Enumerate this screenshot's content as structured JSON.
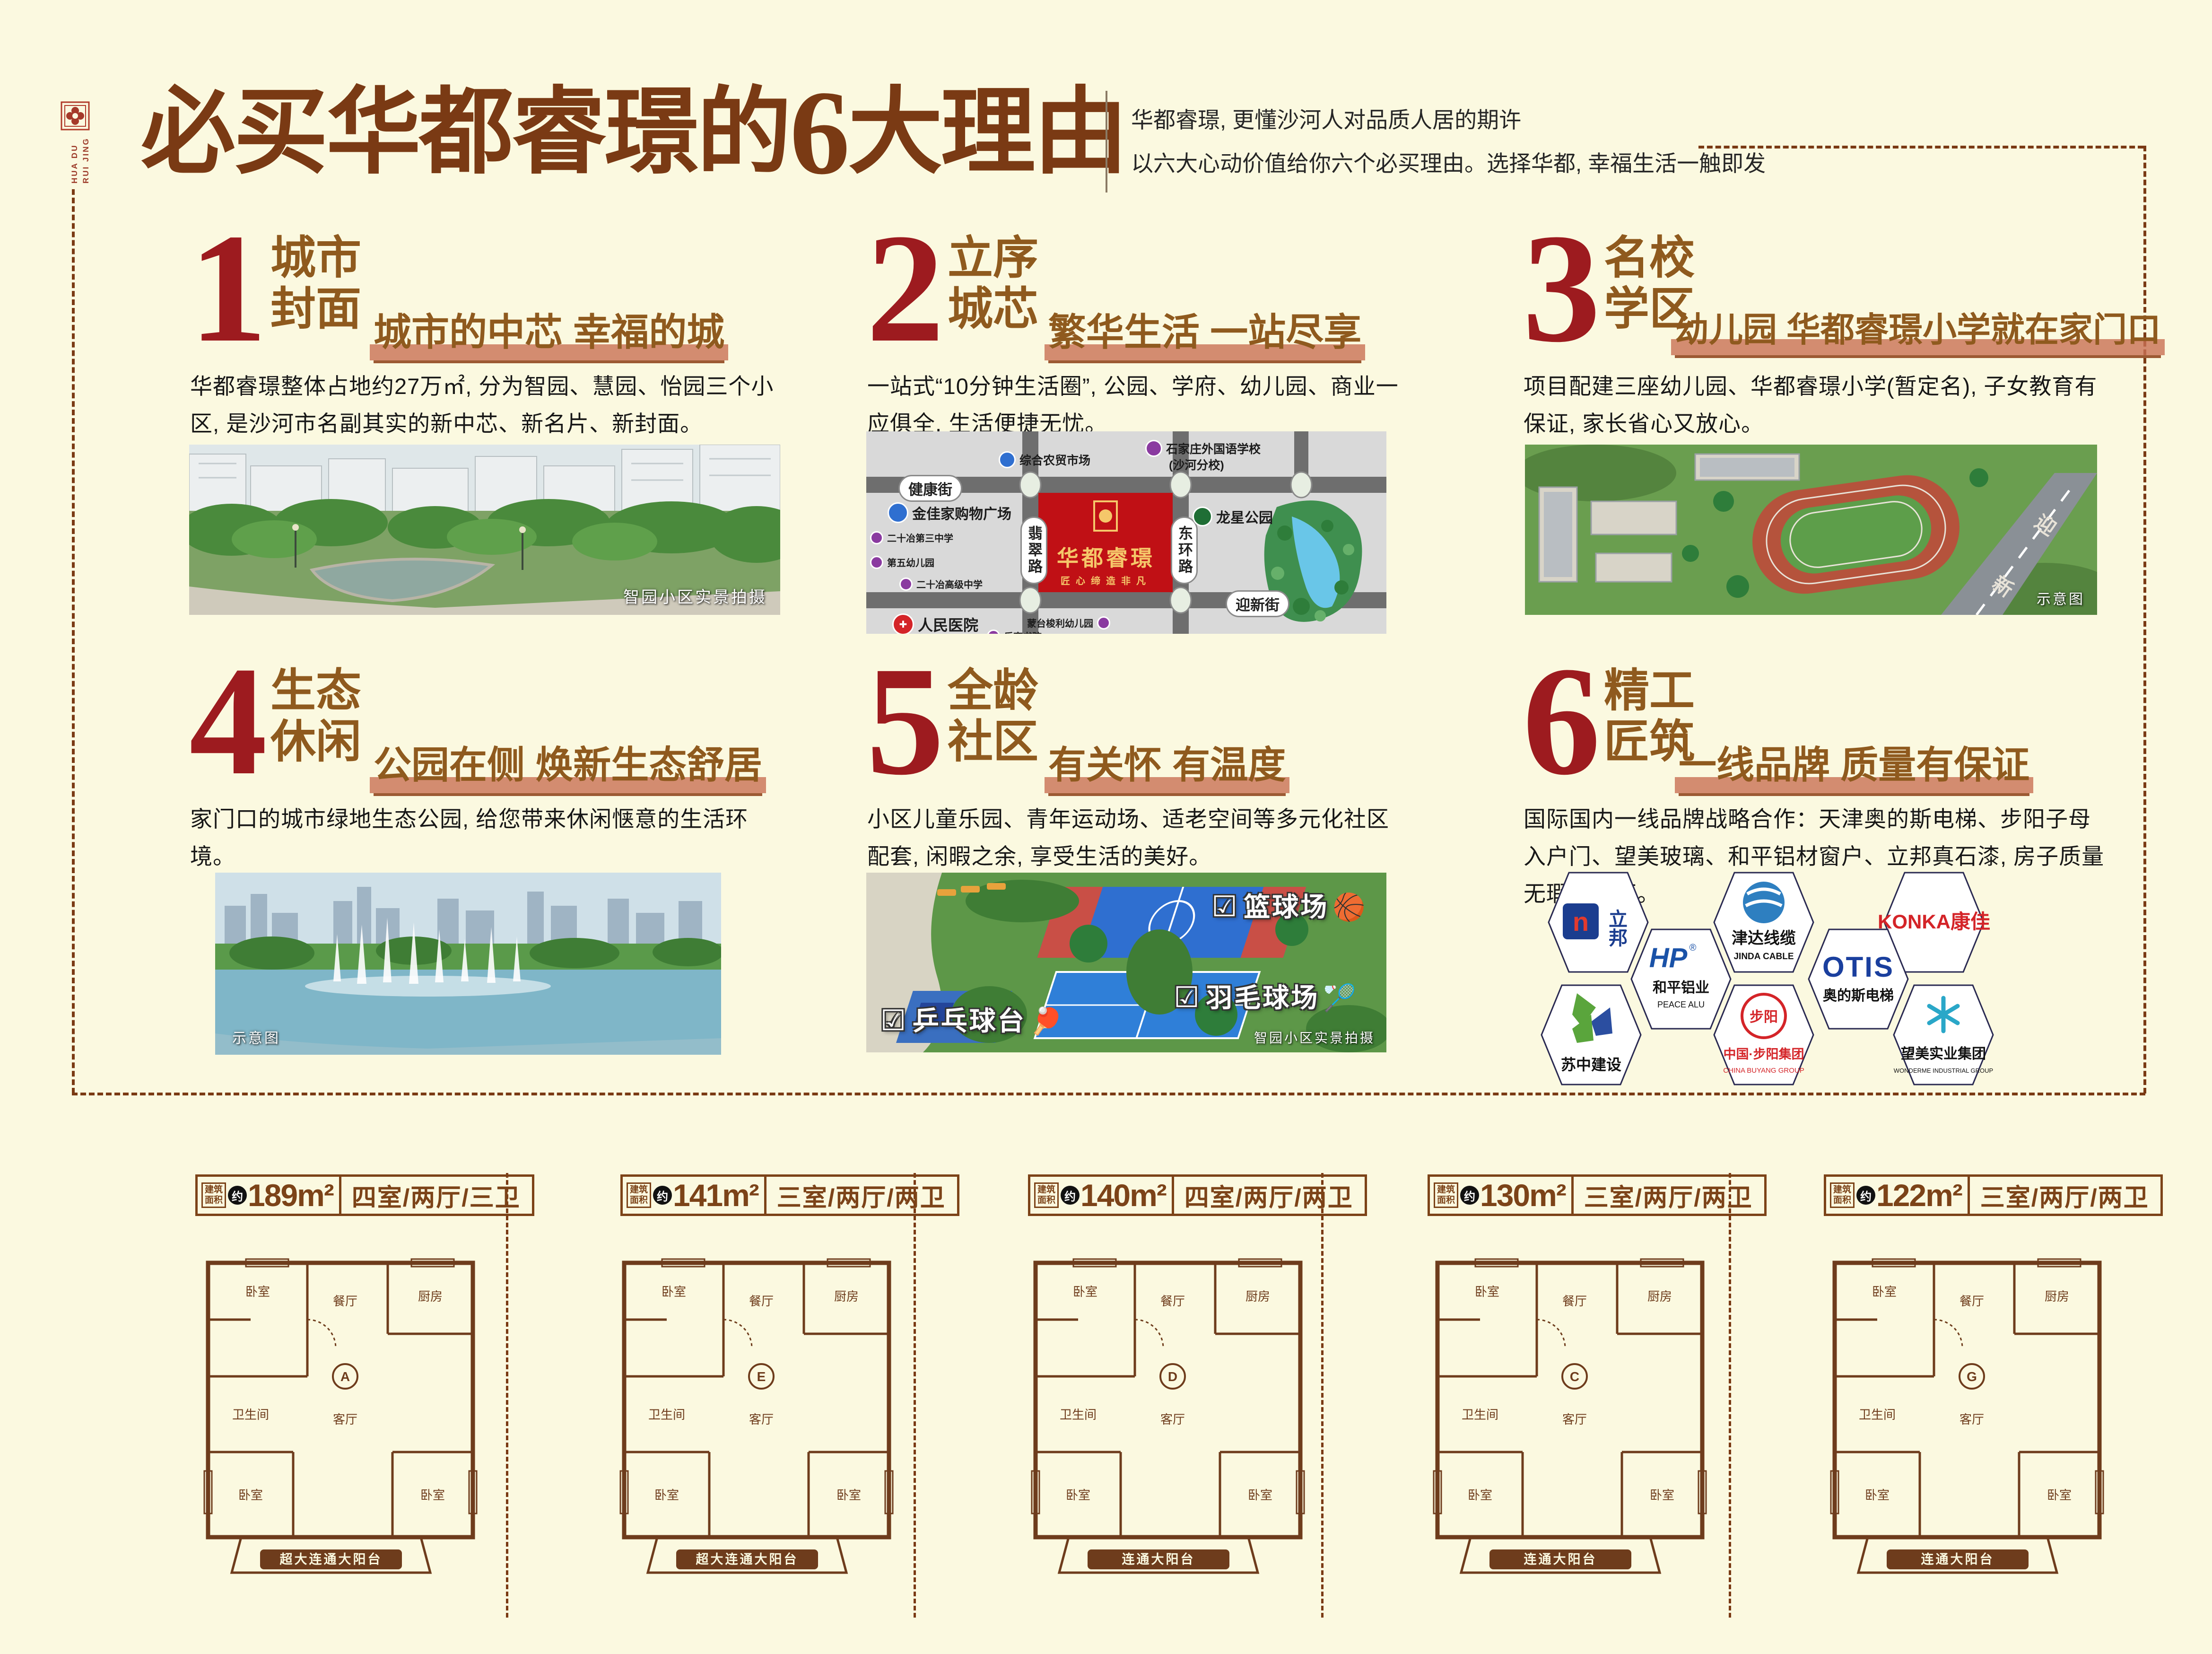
{
  "logo": {
    "line1": "HUA DU",
    "line2": "RUI JING"
  },
  "header": {
    "title_pre": "必买华都睿璟的",
    "title_num": "6",
    "title_post": "大理由",
    "sub1": "华都睿璟, 更懂沙河人对品质人居的期许",
    "sub2": "以六大心动价值给你六个必买理由。选择华都, 幸福生活一触即发"
  },
  "reasons": [
    {
      "num": "1",
      "t1": "城市",
      "t2": "封面",
      "sub": "城市的中芯 幸福的城",
      "desc": "华都睿璟整体占地约27万㎡, 分为智园、慧园、怡园三个小区, 是沙河市名副其实的新中芯、新名片、新封面。",
      "caption": "智园小区实景拍摄"
    },
    {
      "num": "2",
      "t1": "立序",
      "t2": "城芯",
      "sub": "繁华生活 一站尽享",
      "desc": "一站式“10分钟生活圈”, 公园、学府、幼儿园、商业一应俱全, 生活便捷无忧。"
    },
    {
      "num": "3",
      "t1": "名校",
      "t2": "学区",
      "sub": "幼儿园 华都睿璟小学就在家门口",
      "desc": "项目配建三座幼儿园、华都睿璟小学(暂定名), 子女教育有保证, 家长省心又放心。",
      "caption": "示意图",
      "road_char1": "迎",
      "road_char2": "新"
    },
    {
      "num": "4",
      "t1": "生态",
      "t2": "休闲",
      "sub": "公园在侧 焕新生态舒居",
      "desc": "家门口的城市绿地生态公园, 给您带来休闲惬意的生活环境。",
      "caption": "示意图"
    },
    {
      "num": "5",
      "t1": "全龄",
      "t2": "社区",
      "sub": "有关怀 有温度",
      "desc": "小区儿童乐园、青年运动场、适老空间等多元化社区配套, 闲暇之余, 享受生活的美好。",
      "caption": "智园小区实景拍摄",
      "label_basketball": "篮球场",
      "label_badminton": "羽毛球场",
      "label_pingpong": "乒乓球台"
    },
    {
      "num": "6",
      "t1": "精工",
      "t2": "匠筑",
      "sub": "一线品牌 质量有保证",
      "desc": "国际国内一线品牌战略合作：天津奥的斯电梯、步阳子母入户门、望美玻璃、和平铝材窗户、立邦真石漆, 房子质量无瑕有保证。"
    }
  ],
  "map": {
    "project": "华都睿璟",
    "tagline": "匠心缔造非凡",
    "road_h1": "健康街",
    "road_h2": "迎新街",
    "road_v1": "翡翠路",
    "road_v2": "东环路",
    "poi_market": "综合农贸市场",
    "poi_flschool1": "石家庄外国语学校",
    "poi_flschool2": "(沙河分校)",
    "poi_mall": "金佳家购物广场",
    "poi_ms3": "二十冶第三中学",
    "poi_hs": "二十冶高级中学",
    "poi_kg5": "第五幼儿园",
    "poi_park": "龙星公园",
    "poi_hospital": "人民医院",
    "poi_montessori": "蒙台梭利幼儿园",
    "poi_academy": "乐育书院"
  },
  "brands": {
    "nippon": {
      "mark": "n",
      "cn": "立邦"
    },
    "jinda": {
      "cn": "津达线缆",
      "en": "JINDA CABLE"
    },
    "konka": {
      "cn": "KONKA康佳"
    },
    "peace": {
      "mark": "HP",
      "reg": "®",
      "cn": "和平铝业",
      "en": "PEACE ALU"
    },
    "otis": {
      "mark": "OTIS",
      "cn": "奥的斯电梯"
    },
    "suzhong": {
      "cn": "苏中建设"
    },
    "buyang": {
      "inner": "步阳",
      "cn": "中国·步阳集团",
      "en": "CHINA BUYANG GROUP"
    },
    "wonderme": {
      "cn": "望美实业集团",
      "en": "WONDERME INDUSTRIAL GROUP"
    }
  },
  "fp_label": {
    "b1": "建筑",
    "b2": "面积",
    "approx": "约"
  },
  "rooms": {
    "bed": "卧室",
    "living": "客厅",
    "dining": "餐厅",
    "kitchen": "厨房",
    "bath": "卫生间"
  },
  "floorplans": [
    {
      "area": "189m²",
      "layout": "四室/两厅/三卫",
      "balcony": "超大连通大阳台",
      "unit": "A"
    },
    {
      "area": "141m²",
      "layout": "三室/两厅/两卫",
      "balcony": "超大连通大阳台",
      "unit": "E"
    },
    {
      "area": "140m²",
      "layout": "四室/两厅/两卫",
      "balcony": "连通大阳台",
      "unit": "D"
    },
    {
      "area": "130m²",
      "layout": "三室/两厅/两卫",
      "balcony": "连通大阳台",
      "unit": "C"
    },
    {
      "area": "122m²",
      "layout": "三室/两厅/两卫",
      "balcony": "连通大阳台",
      "unit": "G"
    }
  ]
}
